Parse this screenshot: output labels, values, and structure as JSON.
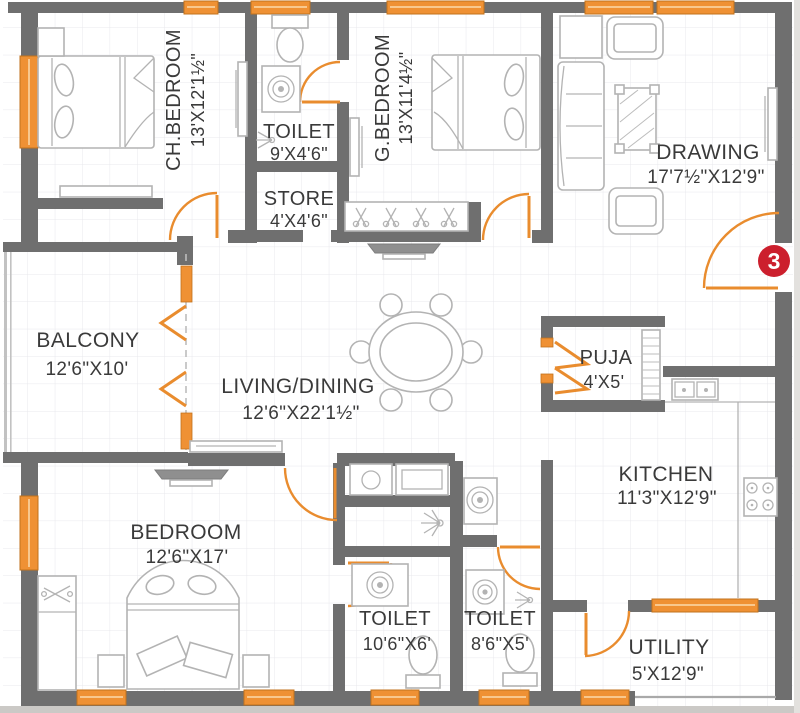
{
  "plan_type": "apartment-floor-plan",
  "unit_badge": "3",
  "rooms": {
    "ch_bedroom": {
      "name": "CH.BEDROOM",
      "dims": "13'X12'1½\""
    },
    "toilet_top": {
      "name": "TOILET",
      "dims": "9'X4'6\""
    },
    "store": {
      "name": "STORE",
      "dims": "4'X4'6\""
    },
    "g_bedroom": {
      "name": "G.BEDROOM",
      "dims": "13'X11'4½\""
    },
    "drawing": {
      "name": "DRAWING",
      "dims": "17'7½\"X12'9\""
    },
    "balcony": {
      "name": "BALCONY",
      "dims": "12'6\"X10'"
    },
    "living_dining": {
      "name": "LIVING/DINING",
      "dims": "12'6\"X22'1½\""
    },
    "puja": {
      "name": "PUJA",
      "dims": "4'X5'"
    },
    "kitchen": {
      "name": "KITCHEN",
      "dims": "11'3\"X12'9\""
    },
    "bedroom": {
      "name": "BEDROOM",
      "dims": "12'6\"X17'"
    },
    "toilet_left": {
      "name": "TOILET",
      "dims": "10'6\"X6'"
    },
    "toilet_right": {
      "name": "TOILET",
      "dims": "8'6\"X5'"
    },
    "utility": {
      "name": "UTILITY",
      "dims": "5'X12'9\""
    }
  },
  "colors": {
    "wall": "#6f6f6f",
    "accent_orange": "#ef9134",
    "badge_red": "#cc1f2d",
    "label_text": "#3a3a3a"
  },
  "symbols": [
    "double-bed",
    "wardrobe",
    "tv-unit",
    "wc",
    "wash-basin",
    "geyser",
    "sofa-set",
    "coffee-table",
    "dining-table",
    "gas-stove",
    "kitchen-sink",
    "shoe-rack",
    "door-swing",
    "folding-door",
    "window"
  ]
}
